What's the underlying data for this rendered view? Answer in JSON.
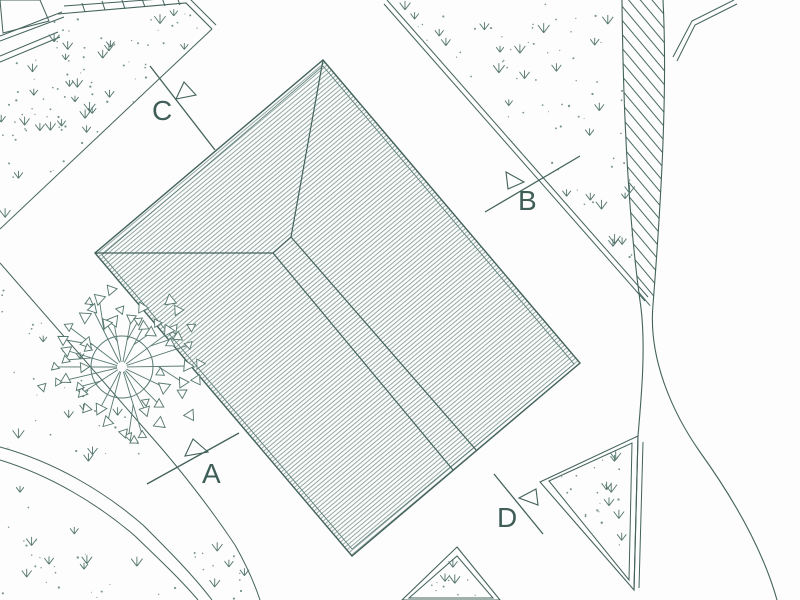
{
  "drawing": {
    "kind": "architectural site plan",
    "markers": [
      {
        "id": "A",
        "label": "A"
      },
      {
        "id": "B",
        "label": "B"
      },
      {
        "id": "C",
        "label": "C"
      },
      {
        "id": "D",
        "label": "D"
      }
    ],
    "colors": {
      "line": "#44625c",
      "roof_hatch": "#6f8a84",
      "grass": "#54756d",
      "speckle": "#7b958e",
      "background": "#fcfdfc",
      "text": "#3f5e58"
    },
    "tree": {
      "cx": 122,
      "cy": 367,
      "trunk_radius": 31,
      "branches": 18,
      "extra_leaves": 26,
      "max_radius": 84
    },
    "grass_regions": [
      {
        "id": "grass-top-left",
        "feet": 26,
        "dots": 70,
        "poly": [
          [
            58,
            18
          ],
          [
            186,
            7
          ],
          [
            210,
            31
          ],
          [
            0,
            230
          ],
          [
            0,
            64
          ]
        ]
      },
      {
        "id": "grass-top-right",
        "feet": 24,
        "dots": 60,
        "poly": [
          [
            390,
            3
          ],
          [
            619,
            3
          ],
          [
            630,
            180
          ],
          [
            643,
            294
          ]
        ]
      },
      {
        "id": "grass-left-middle",
        "feet": 9,
        "dots": 26,
        "poly": [
          [
            0,
            266
          ],
          [
            158,
            446
          ],
          [
            120,
            468
          ],
          [
            0,
            450
          ]
        ]
      },
      {
        "id": "grass-bottom-left",
        "feet": 8,
        "dots": 22,
        "poly": [
          [
            0,
            472
          ],
          [
            128,
            548
          ],
          [
            190,
            600
          ],
          [
            0,
            600
          ]
        ]
      },
      {
        "id": "grass-rhombus",
        "feet": 7,
        "dots": 18,
        "poly": [
          [
            556,
            478
          ],
          [
            627,
            449
          ],
          [
            623,
            572
          ]
        ]
      },
      {
        "id": "grass-bottom-diamond",
        "feet": 3,
        "dots": 8,
        "poly": [
          [
            455,
            562
          ],
          [
            486,
            596
          ],
          [
            415,
            596
          ]
        ]
      },
      {
        "id": "grass-path-wedge",
        "feet": 4,
        "dots": 10,
        "poly": [
          [
            172,
            532
          ],
          [
            238,
            556
          ],
          [
            258,
            600
          ],
          [
            205,
            600
          ]
        ]
      }
    ]
  }
}
